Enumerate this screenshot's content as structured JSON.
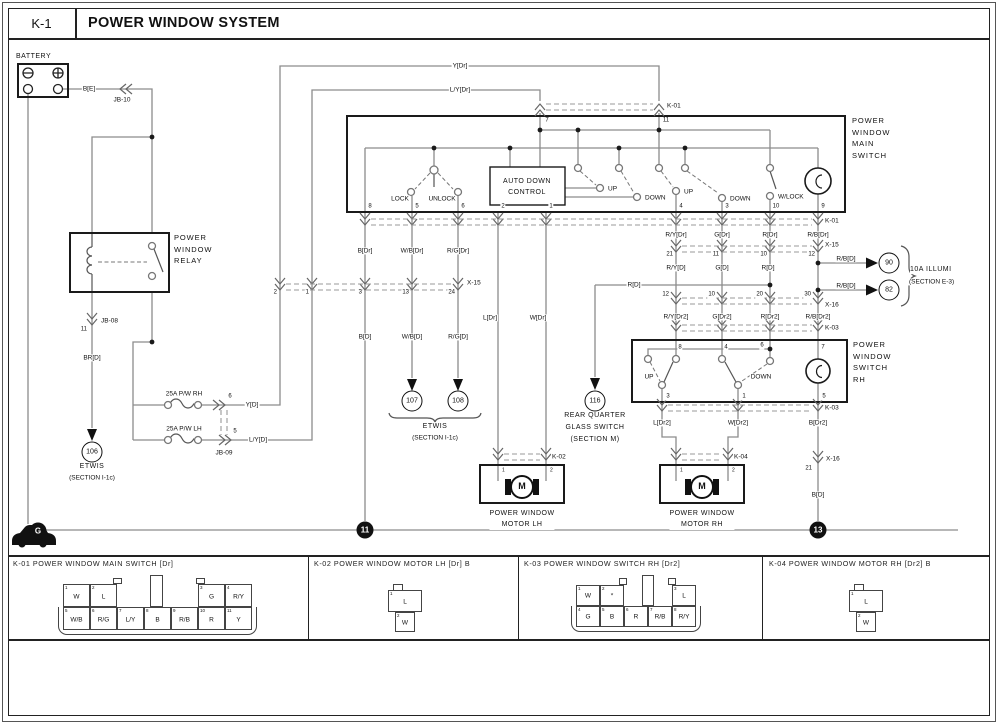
{
  "header": {
    "code": "K-1",
    "title": "POWER WINDOW SYSTEM"
  },
  "labels": [
    {
      "t": "BATTERY",
      "x": 16,
      "y": 57,
      "a": "al",
      "c": "n7",
      "n": "battery-label"
    },
    {
      "t": "B[E]",
      "x": 89,
      "y": 89,
      "a": "ac",
      "c": "w",
      "n": "wire-label"
    },
    {
      "t": "JB-10",
      "x": 122,
      "y": 100,
      "a": "ac",
      "c": "w",
      "n": "connector-label"
    },
    {
      "t": "POWER\nWINDOW\nRELAY",
      "x": 174,
      "y": 249,
      "a": "al",
      "c": "nm",
      "n": "relay-label"
    },
    {
      "t": "JB-08",
      "x": 100,
      "y": 321,
      "a": "al",
      "c": "w",
      "n": "connector-label"
    },
    {
      "t": "11",
      "x": 88,
      "y": 330,
      "a": "ar",
      "c": "p",
      "n": "pin-label"
    },
    {
      "t": "BR[D]",
      "x": 92,
      "y": 358,
      "a": "ac",
      "c": "w",
      "n": "wire-label"
    },
    {
      "t": "ETWIS",
      "x": 92,
      "y": 467,
      "a": "ac",
      "c": "n7",
      "n": "etwis-label"
    },
    {
      "t": "(SECTION I-1c)",
      "x": 92,
      "y": 478,
      "a": "ac",
      "c": "w",
      "n": "section-label"
    },
    {
      "t": "25A P/W RH",
      "x": 184,
      "y": 394,
      "a": "ac",
      "c": "w",
      "n": "fuse-label"
    },
    {
      "t": "6",
      "x": 230,
      "y": 397,
      "a": "ac",
      "c": "p",
      "n": "pin-label"
    },
    {
      "t": "Y[D]",
      "x": 252,
      "y": 405,
      "a": "ac",
      "c": "w",
      "n": "wire-label"
    },
    {
      "t": "25A P/W LH",
      "x": 184,
      "y": 429,
      "a": "ac",
      "c": "w",
      "n": "fuse-label"
    },
    {
      "t": "5",
      "x": 235,
      "y": 432,
      "a": "ac",
      "c": "p",
      "n": "pin-label"
    },
    {
      "t": "L/Y[D]",
      "x": 258,
      "y": 440,
      "a": "ac",
      "c": "w",
      "n": "wire-label"
    },
    {
      "t": "JB-09",
      "x": 224,
      "y": 453,
      "a": "ac",
      "c": "w",
      "n": "connector-label"
    },
    {
      "t": "Y[Dr]",
      "x": 460,
      "y": 66,
      "a": "ac",
      "c": "w",
      "n": "wire-label"
    },
    {
      "t": "L/Y[Dr]",
      "x": 460,
      "y": 90,
      "a": "ac",
      "c": "w",
      "n": "wire-label"
    },
    {
      "t": "K-01",
      "x": 666,
      "y": 106,
      "a": "al",
      "c": "w",
      "n": "connector-label"
    },
    {
      "t": "7",
      "x": 547,
      "y": 121,
      "a": "ac",
      "c": "p",
      "n": "pin-label"
    },
    {
      "t": "11",
      "x": 666,
      "y": 121,
      "a": "ac",
      "c": "p",
      "n": "pin-label"
    },
    {
      "t": "POWER\nWINDOW\nMAIN\nSWITCH",
      "x": 852,
      "y": 138,
      "a": "al",
      "c": "nm",
      "n": "main-switch-label"
    },
    {
      "t": "LOCK",
      "x": 400,
      "y": 199,
      "a": "ac",
      "c": "w",
      "n": "switch-pos-label"
    },
    {
      "t": "UNLOCK",
      "x": 442,
      "y": 199,
      "a": "ac",
      "c": "w",
      "n": "switch-pos-label"
    },
    {
      "t": "AUTO DOWN\nCONTROL",
      "x": 527,
      "y": 187,
      "a": "ac",
      "c": "nc",
      "n": "auto-down-control-label"
    },
    {
      "t": "UP",
      "x": 607,
      "y": 189,
      "a": "al",
      "c": "w",
      "n": "switch-pos-label"
    },
    {
      "t": "DOWN",
      "x": 644,
      "y": 198,
      "a": "al",
      "c": "w",
      "n": "switch-pos-label"
    },
    {
      "t": "UP",
      "x": 683,
      "y": 192,
      "a": "al",
      "c": "w",
      "n": "switch-pos-label"
    },
    {
      "t": "DOWN",
      "x": 729,
      "y": 199,
      "a": "al",
      "c": "w",
      "n": "switch-pos-label"
    },
    {
      "t": "W/LOCK",
      "x": 777,
      "y": 197,
      "a": "al",
      "c": "w",
      "n": "switch-pos-label"
    },
    {
      "t": "8",
      "x": 370,
      "y": 207,
      "a": "ac",
      "c": "p",
      "n": "pin-label"
    },
    {
      "t": "5",
      "x": 417,
      "y": 207,
      "a": "ac",
      "c": "p",
      "n": "pin-label"
    },
    {
      "t": "6",
      "x": 463,
      "y": 207,
      "a": "ac",
      "c": "p",
      "n": "pin-label"
    },
    {
      "t": "2",
      "x": 503,
      "y": 207,
      "a": "ac",
      "c": "p",
      "n": "pin-label"
    },
    {
      "t": "1",
      "x": 551,
      "y": 207,
      "a": "ac",
      "c": "p",
      "n": "pin-label"
    },
    {
      "t": "4",
      "x": 681,
      "y": 207,
      "a": "ac",
      "c": "p",
      "n": "pin-label"
    },
    {
      "t": "3",
      "x": 727,
      "y": 207,
      "a": "ac",
      "c": "p",
      "n": "pin-label"
    },
    {
      "t": "10",
      "x": 776,
      "y": 207,
      "a": "ac",
      "c": "p",
      "n": "pin-label"
    },
    {
      "t": "9",
      "x": 823,
      "y": 207,
      "a": "ac",
      "c": "p",
      "n": "pin-label"
    },
    {
      "t": "K-01",
      "x": 824,
      "y": 221,
      "a": "al",
      "c": "w",
      "n": "connector-label"
    },
    {
      "t": "B[Dr]",
      "x": 365,
      "y": 251,
      "a": "ac",
      "c": "w",
      "n": "wire-label"
    },
    {
      "t": "W/B[Dr]",
      "x": 412,
      "y": 251,
      "a": "ac",
      "c": "w",
      "n": "wire-label"
    },
    {
      "t": "R/G[Dr]",
      "x": 458,
      "y": 251,
      "a": "ac",
      "c": "w",
      "n": "wire-label"
    },
    {
      "t": "R/Y[Dr]",
      "x": 676,
      "y": 235,
      "a": "ac",
      "c": "w",
      "n": "wire-label"
    },
    {
      "t": "G[Dr]",
      "x": 722,
      "y": 235,
      "a": "ac",
      "c": "w",
      "n": "wire-label"
    },
    {
      "t": "R[Dr]",
      "x": 770,
      "y": 235,
      "a": "ac",
      "c": "w",
      "n": "wire-label"
    },
    {
      "t": "R/B[Dr]",
      "x": 818,
      "y": 235,
      "a": "ac",
      "c": "w",
      "n": "wire-label"
    },
    {
      "t": "X-15",
      "x": 466,
      "y": 283,
      "a": "al",
      "c": "w",
      "n": "connector-label"
    },
    {
      "t": "2",
      "x": 278,
      "y": 293,
      "a": "ar",
      "c": "p",
      "n": "pin-label"
    },
    {
      "t": "1",
      "x": 310,
      "y": 293,
      "a": "ar",
      "c": "p",
      "n": "pin-label"
    },
    {
      "t": "3",
      "x": 363,
      "y": 293,
      "a": "ar",
      "c": "p",
      "n": "pin-label"
    },
    {
      "t": "13",
      "x": 410,
      "y": 293,
      "a": "ar",
      "c": "p",
      "n": "pin-label"
    },
    {
      "t": "24",
      "x": 456,
      "y": 293,
      "a": "ar",
      "c": "p",
      "n": "pin-label"
    },
    {
      "t": "X-15",
      "x": 824,
      "y": 245,
      "a": "al",
      "c": "w",
      "n": "connector-label"
    },
    {
      "t": "21",
      "x": 674,
      "y": 255,
      "a": "ar",
      "c": "p",
      "n": "pin-label"
    },
    {
      "t": "11",
      "x": 720,
      "y": 255,
      "a": "ar",
      "c": "p",
      "n": "pin-label"
    },
    {
      "t": "10",
      "x": 768,
      "y": 255,
      "a": "ar",
      "c": "p",
      "n": "pin-label"
    },
    {
      "t": "12",
      "x": 816,
      "y": 255,
      "a": "ar",
      "c": "p",
      "n": "pin-label"
    },
    {
      "t": "R/Y[D]",
      "x": 676,
      "y": 268,
      "a": "ac",
      "c": "w",
      "n": "wire-label"
    },
    {
      "t": "G[D]",
      "x": 722,
      "y": 268,
      "a": "ac",
      "c": "w",
      "n": "wire-label"
    },
    {
      "t": "R[D]",
      "x": 768,
      "y": 268,
      "a": "ac",
      "c": "w",
      "n": "wire-label"
    },
    {
      "t": "R/B[D]",
      "x": 846,
      "y": 259,
      "a": "ac",
      "c": "w",
      "n": "wire-label"
    },
    {
      "t": "R/B[D]",
      "x": 846,
      "y": 286,
      "a": "ac",
      "c": "w",
      "n": "wire-label"
    },
    {
      "t": "10A ILLUMI",
      "x": 910,
      "y": 270,
      "a": "al",
      "c": "n7",
      "n": "illumi-label"
    },
    {
      "t": "(SECTION E-3)",
      "x": 908,
      "y": 282,
      "a": "al",
      "c": "w",
      "n": "section-label"
    },
    {
      "t": "X-16",
      "x": 824,
      "y": 305,
      "a": "al",
      "c": "w",
      "n": "connector-label"
    },
    {
      "t": "12",
      "x": 670,
      "y": 295,
      "a": "ar",
      "c": "p",
      "n": "pin-label"
    },
    {
      "t": "10",
      "x": 716,
      "y": 295,
      "a": "ar",
      "c": "p",
      "n": "pin-label"
    },
    {
      "t": "20",
      "x": 764,
      "y": 295,
      "a": "ar",
      "c": "p",
      "n": "pin-label"
    },
    {
      "t": "30",
      "x": 812,
      "y": 295,
      "a": "ar",
      "c": "p",
      "n": "pin-label"
    },
    {
      "t": "R[D]",
      "x": 634,
      "y": 285,
      "a": "ac",
      "c": "w",
      "n": "wire-label"
    },
    {
      "t": "R/Y[Dr2]",
      "x": 676,
      "y": 317,
      "a": "ac",
      "c": "w",
      "n": "wire-label"
    },
    {
      "t": "G[Dr2]",
      "x": 722,
      "y": 317,
      "a": "ac",
      "c": "w",
      "n": "wire-label"
    },
    {
      "t": "R[Dr2]",
      "x": 770,
      "y": 317,
      "a": "ac",
      "c": "w",
      "n": "wire-label"
    },
    {
      "t": "R/B[Dr2]",
      "x": 818,
      "y": 317,
      "a": "ac",
      "c": "w",
      "n": "wire-label"
    },
    {
      "t": "K-03",
      "x": 824,
      "y": 328,
      "a": "al",
      "c": "w",
      "n": "connector-label"
    },
    {
      "t": "POWER\nWINDOW\nSWITCH\nRH",
      "x": 853,
      "y": 362,
      "a": "al",
      "c": "nm",
      "n": "rh-switch-label"
    },
    {
      "t": "8",
      "x": 680,
      "y": 348,
      "a": "ac",
      "c": "p",
      "n": "pin-label"
    },
    {
      "t": "4",
      "x": 726,
      "y": 348,
      "a": "ac",
      "c": "p",
      "n": "pin-label"
    },
    {
      "t": "6",
      "x": 762,
      "y": 346,
      "a": "ac",
      "c": "p",
      "n": "pin-label"
    },
    {
      "t": "7",
      "x": 823,
      "y": 348,
      "a": "ac",
      "c": "p",
      "n": "pin-label"
    },
    {
      "t": "UP",
      "x": 649,
      "y": 377,
      "a": "ac",
      "c": "w",
      "n": "switch-pos-label"
    },
    {
      "t": "DOWN",
      "x": 761,
      "y": 377,
      "a": "ac",
      "c": "w",
      "n": "switch-pos-label"
    },
    {
      "t": "3",
      "x": 668,
      "y": 397,
      "a": "ac",
      "c": "p",
      "n": "pin-label"
    },
    {
      "t": "1",
      "x": 744,
      "y": 397,
      "a": "ac",
      "c": "p",
      "n": "pin-label"
    },
    {
      "t": "5",
      "x": 824,
      "y": 397,
      "a": "ac",
      "c": "p",
      "n": "pin-label"
    },
    {
      "t": "K-03",
      "x": 824,
      "y": 408,
      "a": "al",
      "c": "w",
      "n": "connector-label"
    },
    {
      "t": "L[Dr2]",
      "x": 662,
      "y": 423,
      "a": "ac",
      "c": "w",
      "n": "wire-label"
    },
    {
      "t": "W[Dr2]",
      "x": 738,
      "y": 423,
      "a": "ac",
      "c": "w",
      "n": "wire-label"
    },
    {
      "t": "B[Dr2]",
      "x": 818,
      "y": 423,
      "a": "ac",
      "c": "w",
      "n": "wire-label"
    },
    {
      "t": "K-02",
      "x": 551,
      "y": 457,
      "a": "al",
      "c": "w",
      "n": "connector-label"
    },
    {
      "t": "K-04",
      "x": 733,
      "y": 457,
      "a": "al",
      "c": "w",
      "n": "connector-label"
    },
    {
      "t": "X-16",
      "x": 825,
      "y": 459,
      "a": "al",
      "c": "w",
      "n": "connector-label"
    },
    {
      "t": "21",
      "x": 813,
      "y": 469,
      "a": "ar",
      "c": "p",
      "n": "pin-label"
    },
    {
      "t": "B[D]",
      "x": 818,
      "y": 495,
      "a": "ac",
      "c": "w",
      "n": "wire-label"
    },
    {
      "t": "L[Dr]",
      "x": 490,
      "y": 318,
      "a": "ac",
      "c": "w",
      "n": "wire-label"
    },
    {
      "t": "W[Dr]",
      "x": 538,
      "y": 318,
      "a": "ac",
      "c": "w",
      "n": "wire-label"
    },
    {
      "t": "B[D]",
      "x": 365,
      "y": 337,
      "a": "ac",
      "c": "w",
      "n": "wire-label"
    },
    {
      "t": "W/B[D]",
      "x": 412,
      "y": 337,
      "a": "ac",
      "c": "w",
      "n": "wire-label"
    },
    {
      "t": "R/G[D]",
      "x": 458,
      "y": 337,
      "a": "ac",
      "c": "w",
      "n": "wire-label"
    },
    {
      "t": "ETWIS",
      "x": 435,
      "y": 427,
      "a": "ac",
      "c": "n7",
      "n": "etwis-label"
    },
    {
      "t": "(SECTION I-1c)",
      "x": 435,
      "y": 438,
      "a": "ac",
      "c": "w",
      "n": "section-label"
    },
    {
      "t": "REAR QUARTER",
      "x": 595,
      "y": 416,
      "a": "ac",
      "c": "n7",
      "n": "rear-quarter-label"
    },
    {
      "t": "GLASS SWITCH",
      "x": 595,
      "y": 428,
      "a": "ac",
      "c": "n7",
      "n": "rear-quarter-label"
    },
    {
      "t": "(SECTION M)",
      "x": 595,
      "y": 440,
      "a": "ac",
      "c": "n7",
      "n": "section-label"
    },
    {
      "t": "1",
      "x": 502,
      "y": 471,
      "a": "al",
      "c": "p5",
      "n": "pin-label"
    },
    {
      "t": "2",
      "x": 550,
      "y": 471,
      "a": "al",
      "c": "p5",
      "n": "pin-label"
    },
    {
      "t": "1",
      "x": 680,
      "y": 471,
      "a": "al",
      "c": "p5",
      "n": "pin-label"
    },
    {
      "t": "2",
      "x": 732,
      "y": 471,
      "a": "al",
      "c": "p5",
      "n": "pin-label"
    },
    {
      "t": "POWER WINDOW\nMOTOR LH",
      "x": 522,
      "y": 519,
      "a": "ac",
      "c": "nc",
      "n": "motor-lh-label"
    },
    {
      "t": "POWER WINDOW\nMOTOR RH",
      "x": 702,
      "y": 519,
      "a": "ac",
      "c": "nc",
      "n": "motor-rh-label"
    },
    {
      "t": "M",
      "x": 522,
      "y": 487,
      "a": "ac",
      "c": "mot",
      "n": "motor-symbol-letter"
    },
    {
      "t": "M",
      "x": 702,
      "y": 487,
      "a": "ac",
      "c": "mot",
      "n": "motor-symbol-letter"
    }
  ],
  "refs": [
    {
      "t": "106",
      "x": 92,
      "y": 452
    },
    {
      "t": "107",
      "x": 412,
      "y": 401
    },
    {
      "t": "108",
      "x": 458,
      "y": 401
    },
    {
      "t": "116",
      "x": 595,
      "y": 401
    },
    {
      "t": "90",
      "x": 889,
      "y": 263
    },
    {
      "t": "82",
      "x": 889,
      "y": 290
    }
  ],
  "grounds": [
    {
      "t": "11",
      "x": 365,
      "y": 530
    },
    {
      "t": "13",
      "x": 818,
      "y": 530
    },
    {
      "t": "G",
      "x": 38,
      "y": 531
    }
  ],
  "panels": [
    {
      "title": "K-01 POWER WINDOW MAIN SWITCH [Dr]",
      "top": [
        {
          "n": "1",
          "c": "W"
        },
        {
          "n": "2",
          "c": "L"
        },
        {
          "n": "3",
          "c": "G"
        },
        {
          "n": "4",
          "c": "R/Y"
        }
      ],
      "bottom": [
        {
          "n": "5",
          "c": "W/B"
        },
        {
          "n": "6",
          "c": "R/G"
        },
        {
          "n": "7",
          "c": "L/Y"
        },
        {
          "n": "8",
          "c": "B"
        },
        {
          "n": "9",
          "c": "R/B"
        },
        {
          "n": "10",
          "c": "R"
        },
        {
          "n": "11",
          "c": "Y"
        }
      ]
    },
    {
      "title": "K-02 POWER WINDOW MOTOR LH [Dr] B",
      "pins": [
        {
          "n": "1",
          "c": "L"
        },
        {
          "n": "2",
          "c": "W"
        }
      ]
    },
    {
      "title": "K-03 POWER WINDOW SWITCH RH [Dr2]",
      "top": [
        {
          "n": "1",
          "c": "W"
        },
        {
          "n": "2",
          "c": "*"
        },
        {
          "n": "3",
          "c": "L"
        }
      ],
      "bottom": [
        {
          "n": "4",
          "c": "G"
        },
        {
          "n": "5",
          "c": "B"
        },
        {
          "n": "6",
          "c": "R"
        },
        {
          "n": "7",
          "c": "R/B"
        },
        {
          "n": "8",
          "c": "R/Y"
        }
      ]
    },
    {
      "title": "K-04 POWER WINDOW MOTOR RH [Dr2] B",
      "pins": [
        {
          "n": "1",
          "c": "L"
        },
        {
          "n": "2",
          "c": "W"
        }
      ]
    }
  ]
}
